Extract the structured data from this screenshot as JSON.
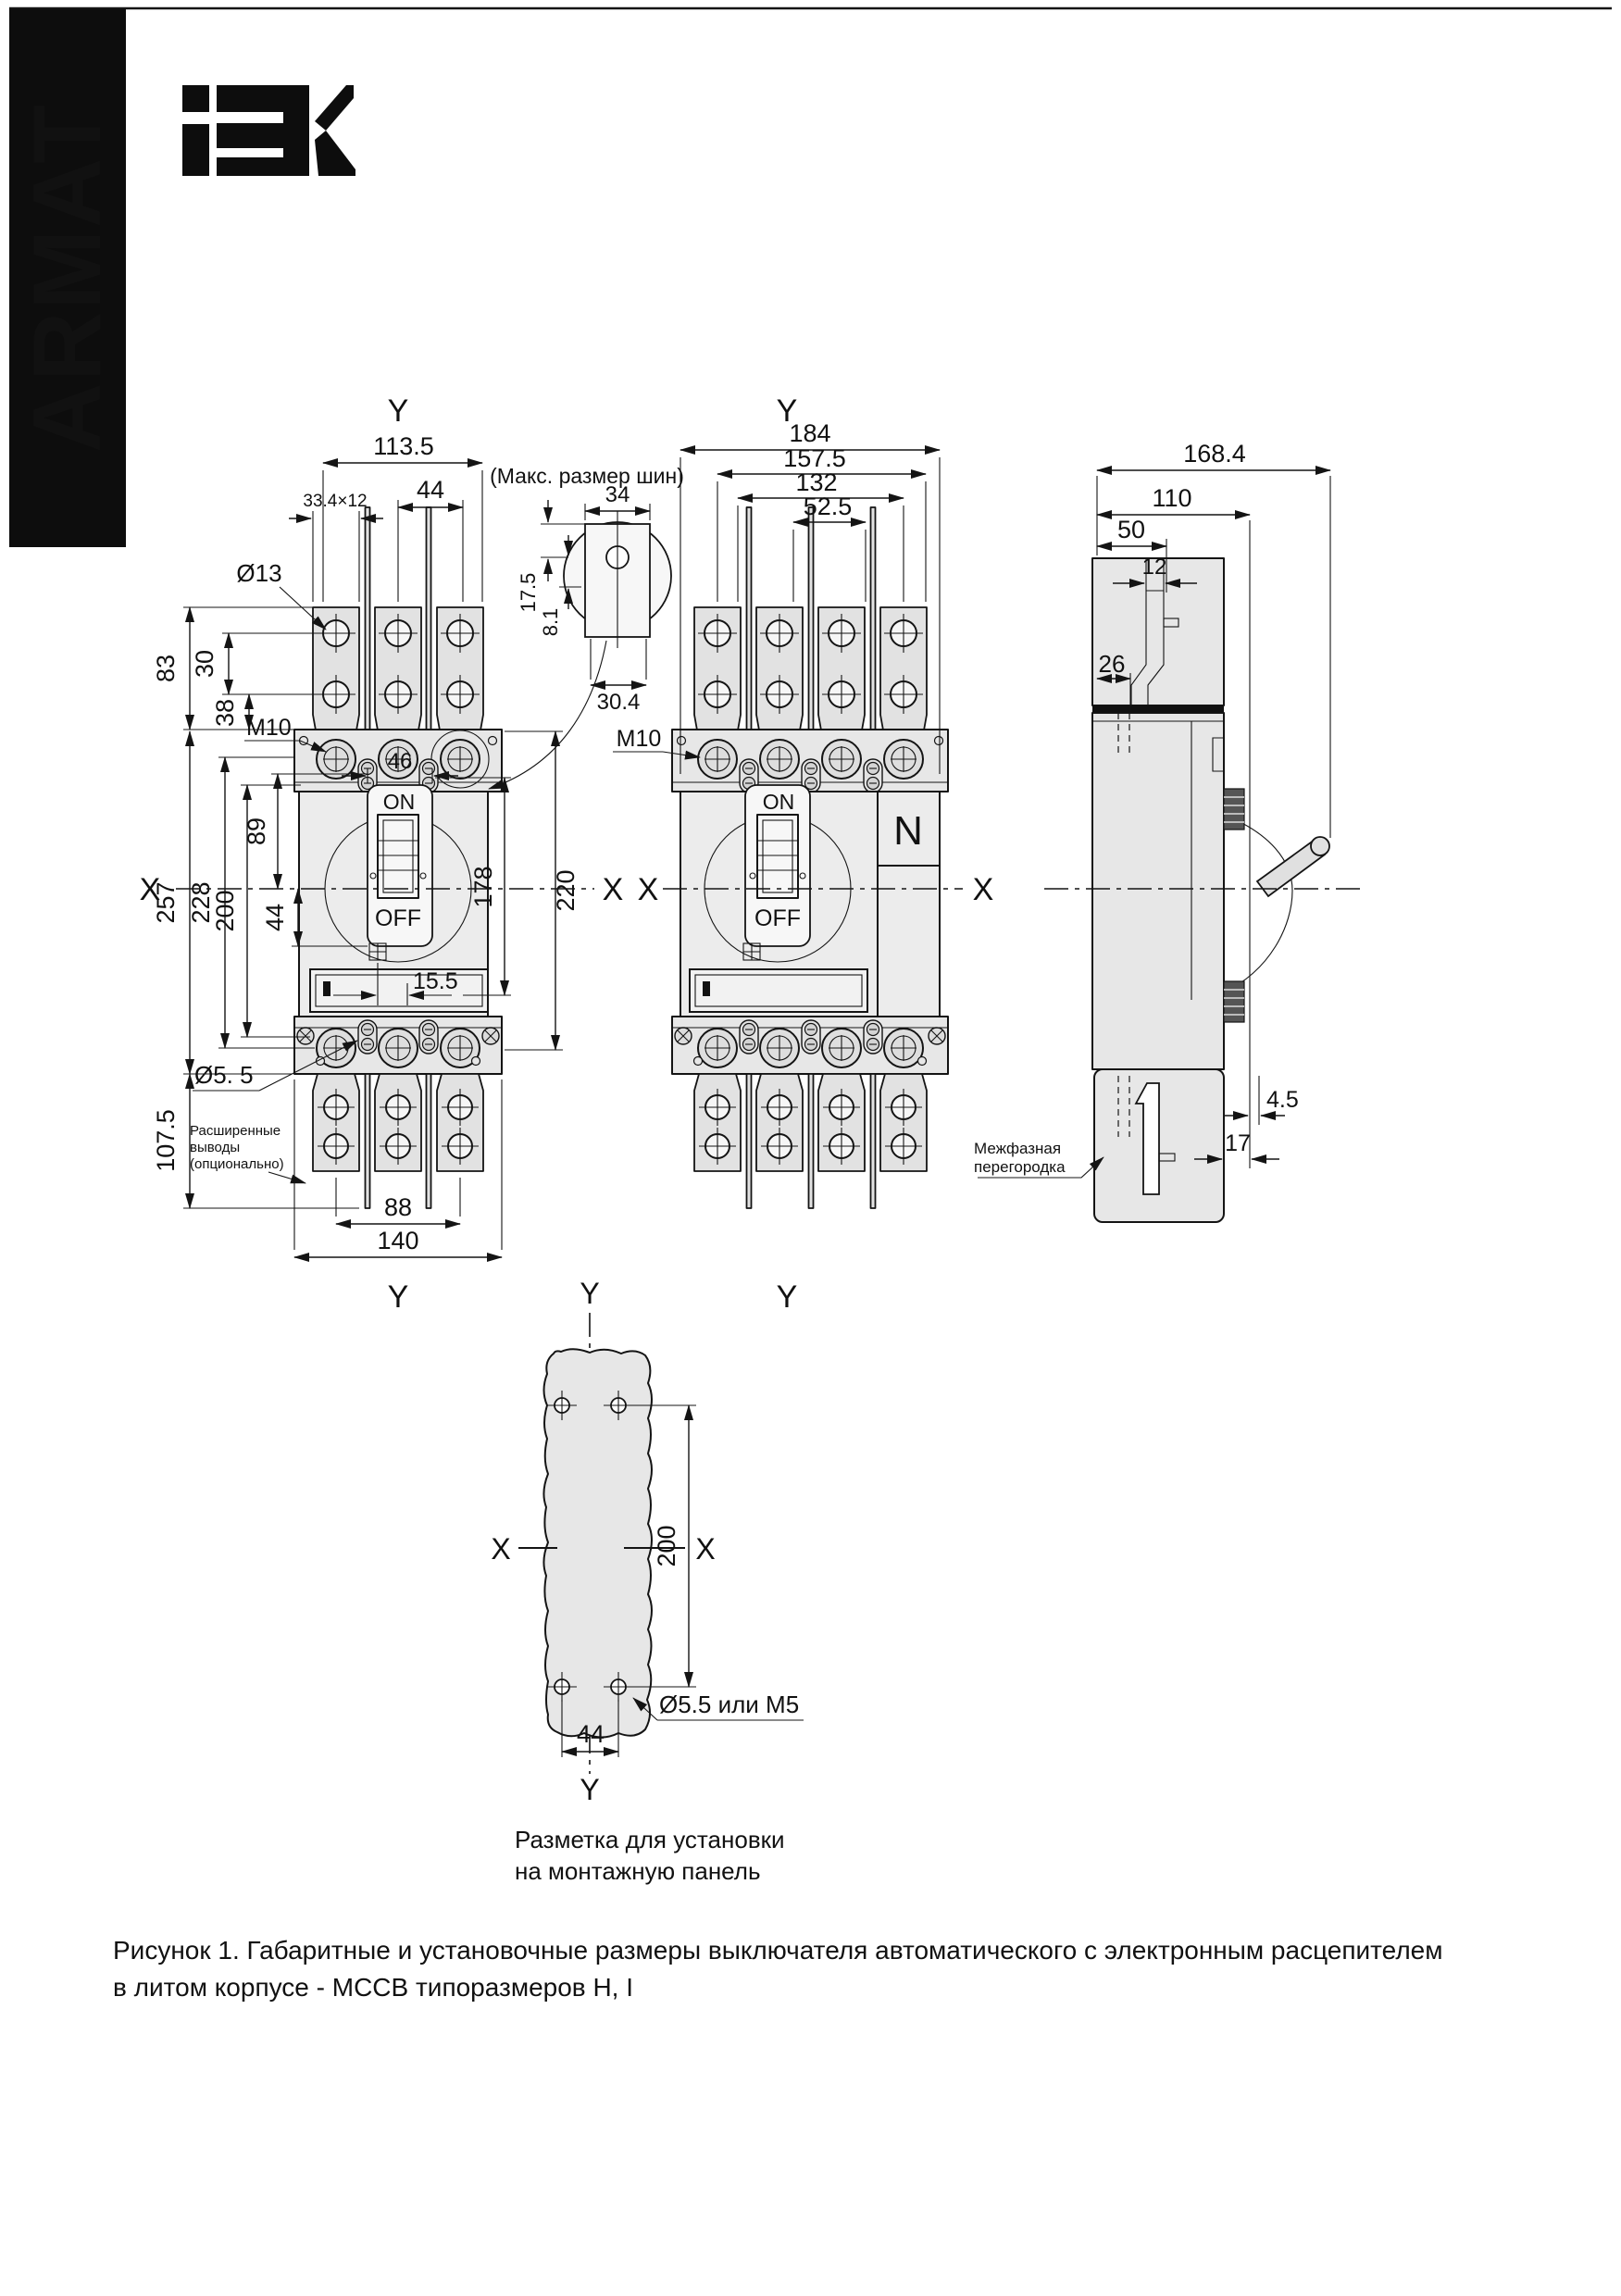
{
  "brand": {
    "armat": "ARMAT",
    "iek": "IEK"
  },
  "axes": {
    "x": "X",
    "y": "Y"
  },
  "front3p": {
    "on": "ON",
    "off": "OFF",
    "dims": {
      "w113": "113.5",
      "p44": "44",
      "bar": "33.4×12",
      "d13": "Ø13",
      "h83": "83",
      "h30": "30",
      "h38": "38",
      "m10": "M10",
      "h257": "257",
      "h228": "228",
      "h200": "200",
      "h89": "89",
      "h44": "44",
      "w46": "46",
      "w155": "15.5",
      "h178": "178",
      "h220": "220",
      "d55": "Ø5. 5",
      "h1075": "107.5",
      "w88": "88",
      "w140": "140"
    },
    "note": [
      "Расширенные",
      "выводы",
      "(опционально)"
    ]
  },
  "busbar": {
    "title": "(Макс. размер шин)",
    "w34": "34",
    "h175": "17.5",
    "h81": "8.1",
    "w304": "30.4"
  },
  "front4p": {
    "on": "ON",
    "off": "OFF",
    "n": "N",
    "dims": {
      "w184": "184",
      "w1575": "157.5",
      "w132": "132",
      "w525": "52.5",
      "m10": "M10"
    }
  },
  "side": {
    "dims": {
      "w1684": "168.4",
      "w110": "110",
      "w50": "50",
      "w12": "12",
      "w26": "26",
      "g45": "4.5",
      "g17": "17"
    },
    "note": [
      "Межфазная",
      "перегородка"
    ]
  },
  "panel": {
    "dims": {
      "h200": "200",
      "w44": "44",
      "hole": "Ø5.5 или М5"
    },
    "note": [
      "Разметка для установки",
      "на монтажную панель"
    ]
  },
  "caption": [
    "Рисунок 1. Габаритные и установочные размеры выключателя автоматического с электронным расцепителем",
    "в литом корпусе - МССВ типоразмеров H, I"
  ]
}
